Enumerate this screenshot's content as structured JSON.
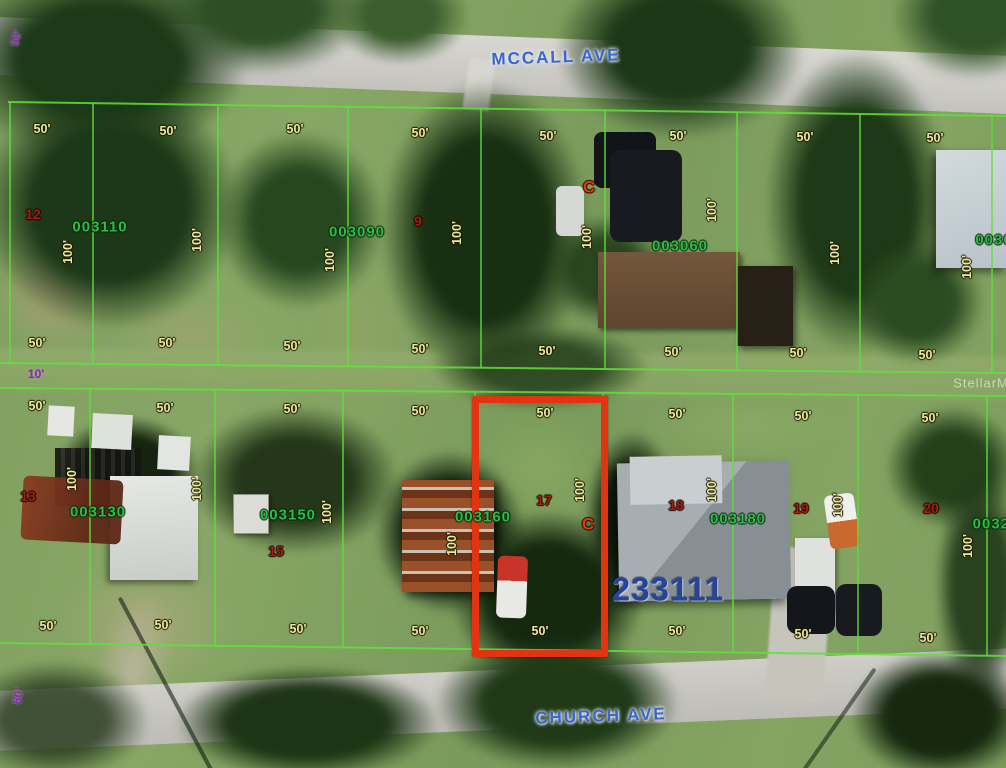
{
  "map": {
    "watermark": "StellarMLS",
    "streets": {
      "top": "MCCALL AVE",
      "bottom": "CHURCH AVE"
    },
    "highlight_parcel": {
      "label": "003160",
      "x": 472,
      "y": 396,
      "width": 136,
      "height": 261,
      "color": "#e23410"
    },
    "colors": {
      "parcel_line": "#5fe13a",
      "dimension_label": "#efe9a0",
      "parcel_number": "#33b94b",
      "lot_number": "#9c2415",
      "c_marker": "#e03a10",
      "street_label": "#3a66c8",
      "offset_label": "#8b2fa8",
      "plat_number": "#27449c",
      "highlight": "#e23410"
    },
    "lines": {
      "horizontal": [
        {
          "x1": 8,
          "y1": 102,
          "x2": 1006,
          "y2": 116
        },
        {
          "x1": 0,
          "y1": 363,
          "x2": 1006,
          "y2": 373
        },
        {
          "x1": 0,
          "y1": 388,
          "x2": 1006,
          "y2": 396
        },
        {
          "x1": 0,
          "y1": 643,
          "x2": 1006,
          "y2": 656
        }
      ],
      "vertical_top": [
        10,
        93,
        218,
        348,
        481,
        605,
        737,
        860,
        992
      ],
      "vertical_bottom": [
        90,
        215,
        343,
        475,
        603,
        733,
        858,
        987
      ]
    },
    "labels": [
      {
        "text": "50'",
        "x": 16,
        "y": 38,
        "rot": -75,
        "cls": "purple",
        "name": "offset-dim-top-left"
      },
      {
        "text": "10'",
        "x": 36,
        "y": 374,
        "rot": 0,
        "cls": "purple",
        "name": "offset-dim-alley"
      },
      {
        "text": "50'",
        "x": 18,
        "y": 696,
        "rot": -80,
        "cls": "purple",
        "name": "offset-dim-bottom-left"
      },
      {
        "text": "MCCALL AVE",
        "x": 556,
        "y": 57,
        "rot": -2,
        "cls": "street",
        "name": "street-label-mccall-ave"
      },
      {
        "text": "CHURCH AVE",
        "x": 601,
        "y": 716,
        "rot": -2,
        "cls": "street",
        "name": "street-label-church-ave"
      },
      {
        "text": "StellarMLS",
        "x": 990,
        "y": 383,
        "rot": 0,
        "cls": "watermark",
        "name": "stellar-mls-watermark"
      },
      {
        "text": "233111",
        "x": 668,
        "y": 589,
        "rot": 0,
        "cls": "plat",
        "name": "plat-number"
      },
      {
        "text": "003110",
        "x": 100,
        "y": 227,
        "rot": 0,
        "cls": "parcel",
        "name": "parcel-id-003110"
      },
      {
        "text": "003090",
        "x": 357,
        "y": 232,
        "rot": 0,
        "cls": "parcel",
        "name": "parcel-id-003090"
      },
      {
        "text": "003060",
        "x": 680,
        "y": 246,
        "rot": 0,
        "cls": "parcel",
        "name": "parcel-id-003060"
      },
      {
        "text": "0030",
        "x": 994,
        "y": 240,
        "rot": 0,
        "cls": "parcel",
        "name": "parcel-id-0030-clipped"
      },
      {
        "text": "003130",
        "x": 98,
        "y": 512,
        "rot": 0,
        "cls": "parcel",
        "name": "parcel-id-003130"
      },
      {
        "text": "003150",
        "x": 288,
        "y": 515,
        "rot": 0,
        "cls": "parcel",
        "name": "parcel-id-003150"
      },
      {
        "text": "003160",
        "x": 483,
        "y": 517,
        "rot": 0,
        "cls": "parcel",
        "name": "parcel-id-003160"
      },
      {
        "text": "003180",
        "x": 738,
        "y": 519,
        "rot": 0,
        "cls": "parcel",
        "name": "parcel-id-003180"
      },
      {
        "text": "00320",
        "x": 996,
        "y": 524,
        "rot": 0,
        "cls": "parcel",
        "name": "parcel-id-00320-clipped"
      },
      {
        "text": "12",
        "x": 33,
        "y": 214,
        "rot": 0,
        "cls": "lot",
        "name": "lot-number-12"
      },
      {
        "text": "9",
        "x": 418,
        "y": 221,
        "rot": 0,
        "cls": "lot",
        "name": "lot-number-9"
      },
      {
        "text": "13",
        "x": 28,
        "y": 496,
        "rot": 0,
        "cls": "lot",
        "name": "lot-number-13"
      },
      {
        "text": "15",
        "x": 276,
        "y": 551,
        "rot": 0,
        "cls": "lot",
        "name": "lot-number-15"
      },
      {
        "text": "17",
        "x": 544,
        "y": 500,
        "rot": 0,
        "cls": "lot",
        "name": "lot-number-17"
      },
      {
        "text": "18",
        "x": 676,
        "y": 505,
        "rot": 0,
        "cls": "lot",
        "name": "lot-number-18"
      },
      {
        "text": "19",
        "x": 801,
        "y": 508,
        "rot": 0,
        "cls": "lot",
        "name": "lot-number-19"
      },
      {
        "text": "20",
        "x": 931,
        "y": 508,
        "rot": 0,
        "cls": "lot",
        "name": "lot-number-20"
      },
      {
        "text": "C",
        "x": 589,
        "y": 187,
        "rot": 0,
        "cls": "c",
        "name": "c-marker-top"
      },
      {
        "text": "C",
        "x": 588,
        "y": 524,
        "rot": 0,
        "cls": "c",
        "name": "c-marker-bottom"
      },
      {
        "text": "50'",
        "x": 42,
        "y": 129,
        "rot": 0,
        "cls": "dim",
        "name": "dimension-label"
      },
      {
        "text": "50'",
        "x": 168,
        "y": 131,
        "rot": 0,
        "cls": "dim",
        "name": "dimension-label"
      },
      {
        "text": "50'",
        "x": 295,
        "y": 129,
        "rot": 0,
        "cls": "dim",
        "name": "dimension-label"
      },
      {
        "text": "50'",
        "x": 420,
        "y": 133,
        "rot": 0,
        "cls": "dim",
        "name": "dimension-label"
      },
      {
        "text": "50'",
        "x": 548,
        "y": 136,
        "rot": 0,
        "cls": "dim",
        "name": "dimension-label"
      },
      {
        "text": "50'",
        "x": 678,
        "y": 136,
        "rot": 0,
        "cls": "dim",
        "name": "dimension-label"
      },
      {
        "text": "50'",
        "x": 805,
        "y": 137,
        "rot": 0,
        "cls": "dim",
        "name": "dimension-label"
      },
      {
        "text": "50'",
        "x": 935,
        "y": 138,
        "rot": 0,
        "cls": "dim",
        "name": "dimension-label"
      },
      {
        "text": "50'",
        "x": 37,
        "y": 343,
        "rot": 0,
        "cls": "dim",
        "name": "dimension-label"
      },
      {
        "text": "50'",
        "x": 167,
        "y": 343,
        "rot": 0,
        "cls": "dim",
        "name": "dimension-label"
      },
      {
        "text": "50'",
        "x": 292,
        "y": 346,
        "rot": 0,
        "cls": "dim",
        "name": "dimension-label"
      },
      {
        "text": "50'",
        "x": 420,
        "y": 349,
        "rot": 0,
        "cls": "dim",
        "name": "dimension-label"
      },
      {
        "text": "50'",
        "x": 547,
        "y": 351,
        "rot": 0,
        "cls": "dim",
        "name": "dimension-label"
      },
      {
        "text": "50'",
        "x": 673,
        "y": 352,
        "rot": 0,
        "cls": "dim",
        "name": "dimension-label"
      },
      {
        "text": "50'",
        "x": 798,
        "y": 353,
        "rot": 0,
        "cls": "dim",
        "name": "dimension-label"
      },
      {
        "text": "50'",
        "x": 927,
        "y": 355,
        "rot": 0,
        "cls": "dim",
        "name": "dimension-label"
      },
      {
        "text": "100'",
        "x": 68,
        "y": 252,
        "rot": -90,
        "cls": "dim",
        "name": "dimension-label"
      },
      {
        "text": "100'",
        "x": 197,
        "y": 240,
        "rot": -90,
        "cls": "dim",
        "name": "dimension-label"
      },
      {
        "text": "100'",
        "x": 330,
        "y": 260,
        "rot": -90,
        "cls": "dim",
        "name": "dimension-label"
      },
      {
        "text": "100'",
        "x": 457,
        "y": 233,
        "rot": -90,
        "cls": "dim",
        "name": "dimension-label"
      },
      {
        "text": "100'",
        "x": 587,
        "y": 237,
        "rot": -90,
        "cls": "dim",
        "name": "dimension-label"
      },
      {
        "text": "100'",
        "x": 712,
        "y": 210,
        "rot": -90,
        "cls": "dim",
        "name": "dimension-label"
      },
      {
        "text": "100'",
        "x": 835,
        "y": 253,
        "rot": -90,
        "cls": "dim",
        "name": "dimension-label"
      },
      {
        "text": "100'",
        "x": 967,
        "y": 267,
        "rot": -90,
        "cls": "dim",
        "name": "dimension-label"
      },
      {
        "text": "50'",
        "x": 37,
        "y": 406,
        "rot": 0,
        "cls": "dim",
        "name": "dimension-label"
      },
      {
        "text": "50'",
        "x": 165,
        "y": 408,
        "rot": 0,
        "cls": "dim",
        "name": "dimension-label"
      },
      {
        "text": "50'",
        "x": 292,
        "y": 409,
        "rot": 0,
        "cls": "dim",
        "name": "dimension-label"
      },
      {
        "text": "50'",
        "x": 420,
        "y": 411,
        "rot": 0,
        "cls": "dim",
        "name": "dimension-label"
      },
      {
        "text": "50'",
        "x": 545,
        "y": 413,
        "rot": 0,
        "cls": "dim",
        "name": "dimension-label"
      },
      {
        "text": "50'",
        "x": 677,
        "y": 414,
        "rot": 0,
        "cls": "dim",
        "name": "dimension-label"
      },
      {
        "text": "50'",
        "x": 803,
        "y": 416,
        "rot": 0,
        "cls": "dim",
        "name": "dimension-label"
      },
      {
        "text": "50'",
        "x": 930,
        "y": 418,
        "rot": 0,
        "cls": "dim",
        "name": "dimension-label"
      },
      {
        "text": "50'",
        "x": 48,
        "y": 626,
        "rot": 0,
        "cls": "dim",
        "name": "dimension-label"
      },
      {
        "text": "50'",
        "x": 163,
        "y": 625,
        "rot": 0,
        "cls": "dim",
        "name": "dimension-label"
      },
      {
        "text": "50'",
        "x": 298,
        "y": 629,
        "rot": 0,
        "cls": "dim",
        "name": "dimension-label"
      },
      {
        "text": "50'",
        "x": 420,
        "y": 631,
        "rot": 0,
        "cls": "dim",
        "name": "dimension-label"
      },
      {
        "text": "50'",
        "x": 540,
        "y": 631,
        "rot": 0,
        "cls": "dim",
        "name": "dimension-label"
      },
      {
        "text": "50'",
        "x": 677,
        "y": 631,
        "rot": 0,
        "cls": "dim",
        "name": "dimension-label"
      },
      {
        "text": "50'",
        "x": 803,
        "y": 634,
        "rot": 0,
        "cls": "dim",
        "name": "dimension-label"
      },
      {
        "text": "50'",
        "x": 928,
        "y": 638,
        "rot": 0,
        "cls": "dim",
        "name": "dimension-label"
      },
      {
        "text": "100'",
        "x": 72,
        "y": 479,
        "rot": -90,
        "cls": "dim",
        "name": "dimension-label"
      },
      {
        "text": "100'",
        "x": 197,
        "y": 489,
        "rot": -90,
        "cls": "dim",
        "name": "dimension-label"
      },
      {
        "text": "100'",
        "x": 327,
        "y": 512,
        "rot": -90,
        "cls": "dim",
        "name": "dimension-label"
      },
      {
        "text": "100'",
        "x": 452,
        "y": 544,
        "rot": -90,
        "cls": "dim",
        "name": "dimension-label"
      },
      {
        "text": "100'",
        "x": 580,
        "y": 490,
        "rot": -90,
        "cls": "dim",
        "name": "dimension-label"
      },
      {
        "text": "100'",
        "x": 712,
        "y": 490,
        "rot": -90,
        "cls": "dim",
        "name": "dimension-label"
      },
      {
        "text": "100'",
        "x": 838,
        "y": 505,
        "rot": -90,
        "cls": "dim",
        "name": "dimension-label"
      },
      {
        "text": "100'",
        "x": 968,
        "y": 546,
        "rot": -90,
        "cls": "dim",
        "name": "dimension-label"
      }
    ]
  }
}
